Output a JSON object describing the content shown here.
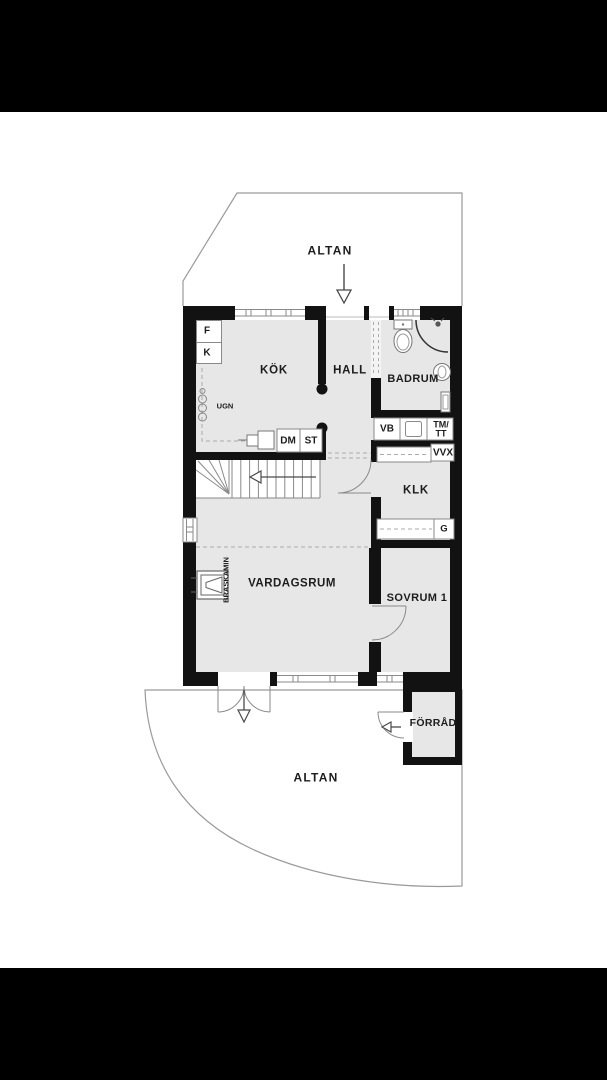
{
  "page": {
    "type": "floor-plan-photo",
    "background": "#000000",
    "canvas": "#ffffff"
  },
  "floorplan": {
    "colors": {
      "wall": "#121212",
      "floor": "#e7e7e7",
      "outline": "#9a9a9a",
      "fixture_stroke": "#777777",
      "dash": "#ababab",
      "text": "#1d1d1d",
      "arrow": "#4a4a4a"
    },
    "rooms": [
      {
        "id": "altan-top",
        "label": "ALTAN",
        "x": 330,
        "y": 251,
        "fs": 12,
        "ls": 1.2
      },
      {
        "id": "kok",
        "label": "KÖK",
        "x": 274,
        "y": 371,
        "fs": 11.5,
        "ls": 0.8
      },
      {
        "id": "hall",
        "label": "HALL",
        "x": 350,
        "y": 371,
        "fs": 11.5,
        "ls": 0.8
      },
      {
        "id": "badrum",
        "label": "BADRUM",
        "x": 413,
        "y": 379,
        "fs": 11,
        "ls": 0.4
      },
      {
        "id": "klk",
        "label": "KLK",
        "x": 416,
        "y": 491,
        "fs": 11.5,
        "ls": 0.8
      },
      {
        "id": "vardagsrum",
        "label": "VARDAGSRUM",
        "x": 292,
        "y": 584,
        "fs": 11.5,
        "ls": 0.5
      },
      {
        "id": "sovrum-1",
        "label": "SOVRUM 1",
        "x": 417,
        "y": 598,
        "fs": 11,
        "ls": 0.4
      },
      {
        "id": "forrad",
        "label": "FÖRRÅD",
        "x": 433,
        "y": 724,
        "fs": 10.5,
        "ls": 0.3
      },
      {
        "id": "altan-bottom",
        "label": "ALTAN",
        "x": 316,
        "y": 778,
        "fs": 12,
        "ls": 1.2
      }
    ],
    "fixtures": [
      {
        "id": "f-cabinet",
        "label": "F",
        "x": 207,
        "y": 331,
        "fs": 10
      },
      {
        "id": "k-cabinet",
        "label": "K",
        "x": 207,
        "y": 353,
        "fs": 10
      },
      {
        "id": "ugn",
        "label": "UGN",
        "x": 225,
        "y": 406,
        "fs": 7.5
      },
      {
        "id": "dm",
        "label": "DM",
        "x": 288,
        "y": 440.5,
        "fs": 10
      },
      {
        "id": "st",
        "label": "ST",
        "x": 311,
        "y": 440.5,
        "fs": 10
      },
      {
        "id": "vb",
        "label": "VB",
        "x": 387,
        "y": 429,
        "fs": 10
      },
      {
        "id": "tm-tt",
        "label": "TM/\nTT",
        "x": 441,
        "y": 429,
        "fs": 9
      },
      {
        "id": "vvx",
        "label": "VVX",
        "x": 443,
        "y": 453,
        "fs": 10
      },
      {
        "id": "g-wardrobe",
        "label": "G",
        "x": 444,
        "y": 529,
        "fs": 9.5
      },
      {
        "id": "braskamin",
        "label": "BRASKAMIN",
        "x": 226,
        "y": 580,
        "fs": 7.5,
        "rotate": -90
      }
    ],
    "arrows": [
      {
        "id": "entry-arrow",
        "direction": "down",
        "meaning": "entrance from upper terrace"
      },
      {
        "id": "terrace-door-arrow",
        "direction": "down",
        "meaning": "double door to lower terrace"
      },
      {
        "id": "stairs-arrow",
        "direction": "left",
        "meaning": "stair direction"
      },
      {
        "id": "forrad-door-arrow",
        "direction": "left",
        "meaning": "storage door opens to terrace"
      }
    ]
  }
}
